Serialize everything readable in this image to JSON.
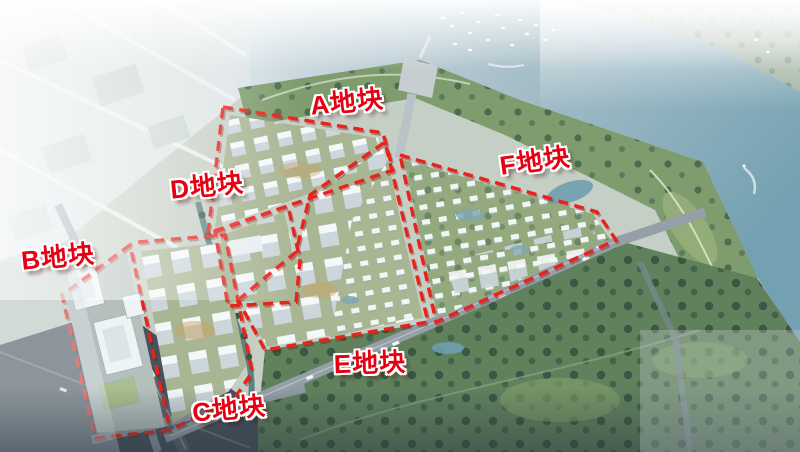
{
  "plots": [
    {
      "id": "A",
      "label": "A地块"
    },
    {
      "id": "B",
      "label": "B地块"
    },
    {
      "id": "C",
      "label": "C地块"
    },
    {
      "id": "D",
      "label": "D地块"
    },
    {
      "id": "E",
      "label": "E地块"
    },
    {
      "id": "F",
      "label": "F地块"
    }
  ],
  "colors": {
    "label_red": "#e60012",
    "boundary_red": "#e7231b",
    "water_deep": "#76a2b2",
    "water_haze": "#dde7ea",
    "park_dark": "#5c7b58",
    "park_light": "#7e9c6d",
    "building_white": "#f2f5f6",
    "road_gray": "#8f9aa2"
  }
}
